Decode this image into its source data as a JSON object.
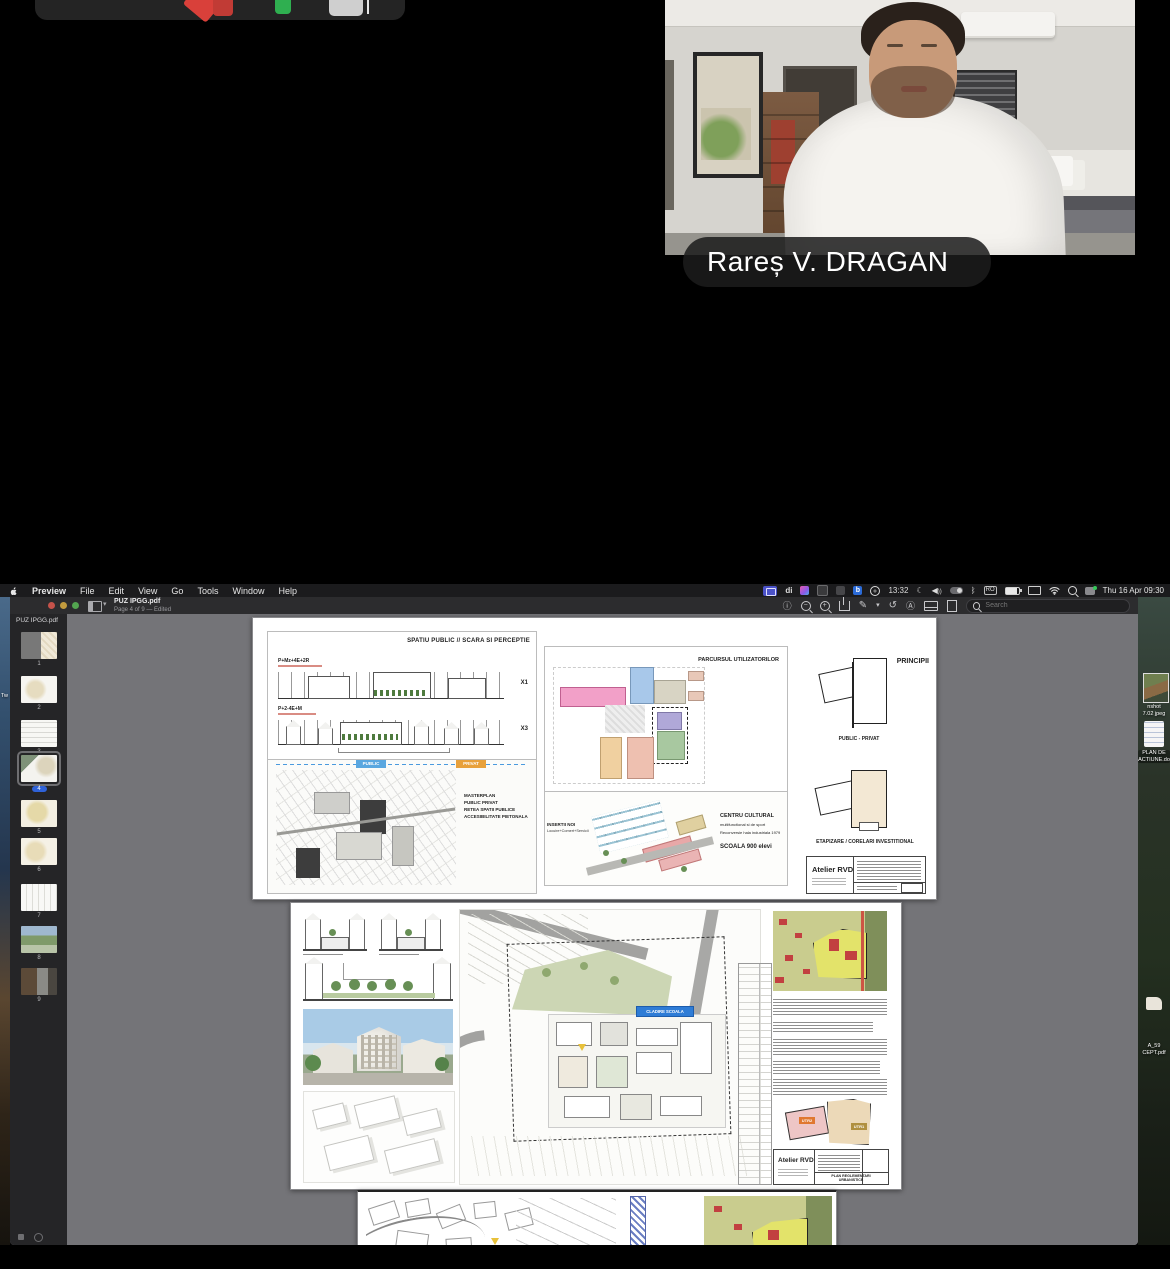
{
  "meeting": {
    "participant_name": "Rareș V. DRAGAN"
  },
  "menubar": {
    "app_menus": [
      "Preview",
      "File",
      "Edit",
      "View",
      "Go",
      "Tools",
      "Window",
      "Help"
    ],
    "status_di": "di",
    "status_b": "b",
    "status_time_alt": "13:32",
    "status_input": "RO",
    "clock": "Thu 16 Apr 09:30"
  },
  "titlebar": {
    "title": "PUZ IPGG.pdf",
    "subtitle": "Page 4 of 9 — Edited",
    "search_placeholder": "Search"
  },
  "sidebar": {
    "doc_label": "PUZ IPGG.pdf",
    "pages": [
      {
        "num": "1"
      },
      {
        "num": "2"
      },
      {
        "num": "3"
      },
      {
        "num": "4"
      },
      {
        "num": "5"
      },
      {
        "num": "6"
      },
      {
        "num": "7"
      },
      {
        "num": "8"
      },
      {
        "num": "9"
      }
    ]
  },
  "sheet1": {
    "scara_title": "SPATIU PUBLIC // SCARA SI PERCEPTIE",
    "elev1_label": "P+Mz+4E+2R",
    "elev1_mark": "X1",
    "elev2_label": "P+2-4E+M",
    "elev2_mark": "X3",
    "mp_l1": "MASTERPLAN",
    "mp_l2": "PUBLIC PRIVAT",
    "mp_l3": "RETEA SPATII PUBLICE",
    "mp_l4": "ACCESIBILITATE PIETONALA",
    "chip_public": "PUBLIC",
    "chip_privat": "PRIVAT",
    "parcursul_title": "PARCURSUL UTILIZATORILOR",
    "principii_title": "PRINCIPII",
    "public_privat": "PUBLIC - PRIVAT",
    "etapizare": "ETAPIZARE / CORELARI INVESTITIONAL",
    "insertii_l1": "INSERTII NOI",
    "insertii_l2": "Locuire+Comert+Servicii",
    "centru_bold": "CENTRU CULTURAL",
    "centru_rest": "multifunctional si de sport",
    "centru_sub": "Reconversie hala industriala 1979",
    "scoala": "SCOALA 900 elevi",
    "atelier": "Atelier RVD"
  },
  "sheet2": {
    "school_chip": "CLADIRE SCOALA",
    "utr1": "UTR1",
    "utr2": "UTR2",
    "atelier": "Atelier RVD",
    "plan_title_l1": "PLAN REGLEMENTARI",
    "plan_title_l2": "URBANISTICE"
  },
  "desktop": {
    "left_label": "Tw",
    "icon1_l1": "nshot",
    "icon1_l2": "7.02 jpeg",
    "icon2_l1": "PLAN DE",
    "icon2_l2": "ACTIUNE.do",
    "icon3_l1": "A_59",
    "icon3_l2": "CEPT.pdf"
  },
  "colors": {
    "accent_blue": "#2f62d8",
    "chip_public": "#5aa7e0",
    "chip_privat": "#e8a13c",
    "school_chip_blue": "#2e7cd6"
  }
}
